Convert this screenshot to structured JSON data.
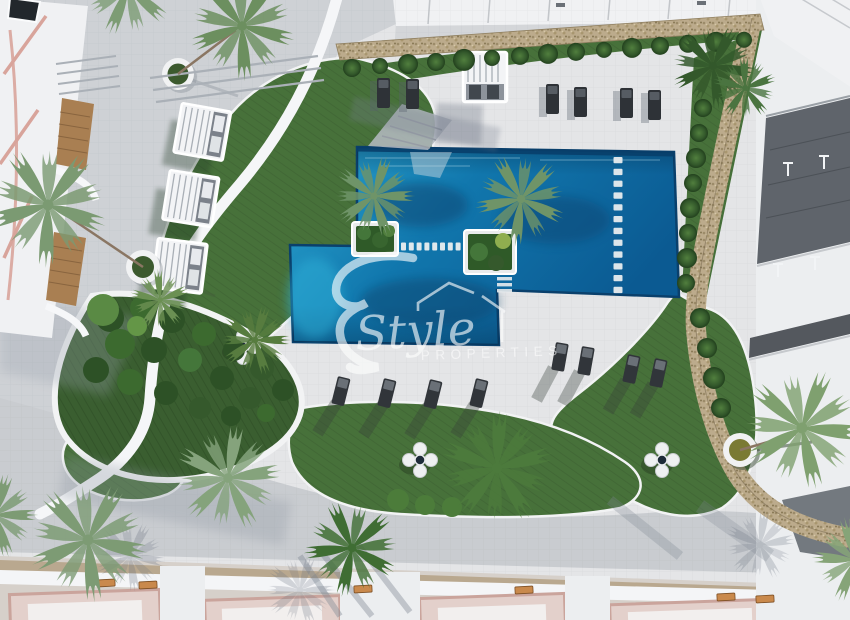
{
  "watermark": {
    "script_text": "Style",
    "caps_text": "PROPERTIES",
    "monogram_icon": "script-e-monogram-icon",
    "house_icon": "house-outline-icon"
  },
  "scene_objects": [
    "swimming-pool",
    "pool-stepping-stones",
    "pool-planter-island",
    "sun-lounger",
    "pergola-cabana",
    "pouf-seating-cluster",
    "round-planter",
    "palm-tree",
    "hedge-bush",
    "stone-wall",
    "lawn",
    "garden",
    "pool-deck",
    "walkway",
    "residential-building",
    "wooden-bench",
    "clothesline-pole"
  ],
  "colors": {
    "deck": "#e4e5e7",
    "walkway": "#ced1d5",
    "walkway_bottom": "#c9ccd0",
    "grass": "#47713a",
    "grass_dark": "#3a5e30",
    "pool_light": "#2ba4cf",
    "pool_mid": "#1177ad",
    "pool_deep": "#0b5a92",
    "pool_edge": "#0a406c",
    "stone": "#bcab8c",
    "pergola": "#f3f4f6",
    "lounger": "#2f3338",
    "building_white": "#f0f1f3",
    "building_pink": "#d8a49b",
    "wood": "#a97f52",
    "roof_pink": "#e3d0cb",
    "terrace_gray": "#5f646b",
    "watermark": "#ffffff"
  }
}
